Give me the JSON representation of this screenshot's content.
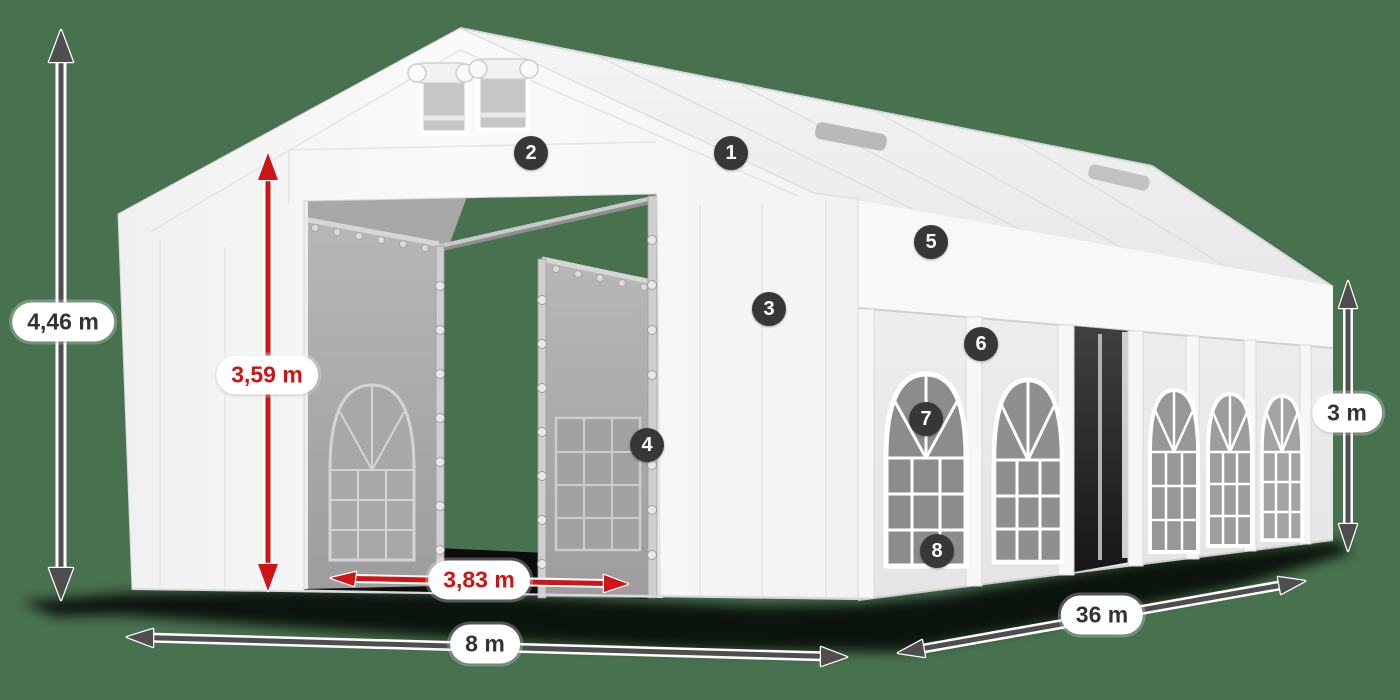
{
  "scene": {
    "description": "White marquee party tent 8 m x 36 m product diagram with dimension annotations and numbered part markers",
    "background_color": "#48714F"
  },
  "colors": {
    "annotation_gray": "#4e4e4e",
    "annotation_red": "#d01315",
    "pill_background": "#ffffff",
    "pill_text": "#333333",
    "pill_text_red": "#cf1315",
    "badge_background": "#373737",
    "badge_text": "#ffffff",
    "tent_white": "#f5f5f5"
  },
  "dimensions": [
    {
      "id": "total-height",
      "label": "4,46 m",
      "color": "gray"
    },
    {
      "id": "door-height",
      "label": "3,59 m",
      "color": "red"
    },
    {
      "id": "door-width",
      "label": "3,83 m",
      "color": "red"
    },
    {
      "id": "front-width",
      "label": "8 m",
      "color": "gray"
    },
    {
      "id": "side-length",
      "label": "36 m",
      "color": "gray"
    },
    {
      "id": "side-height",
      "label": "3 m",
      "color": "gray"
    }
  ],
  "markers": [
    {
      "number": "1"
    },
    {
      "number": "2"
    },
    {
      "number": "3"
    },
    {
      "number": "4"
    },
    {
      "number": "5"
    },
    {
      "number": "6"
    },
    {
      "number": "7"
    },
    {
      "number": "8"
    }
  ]
}
